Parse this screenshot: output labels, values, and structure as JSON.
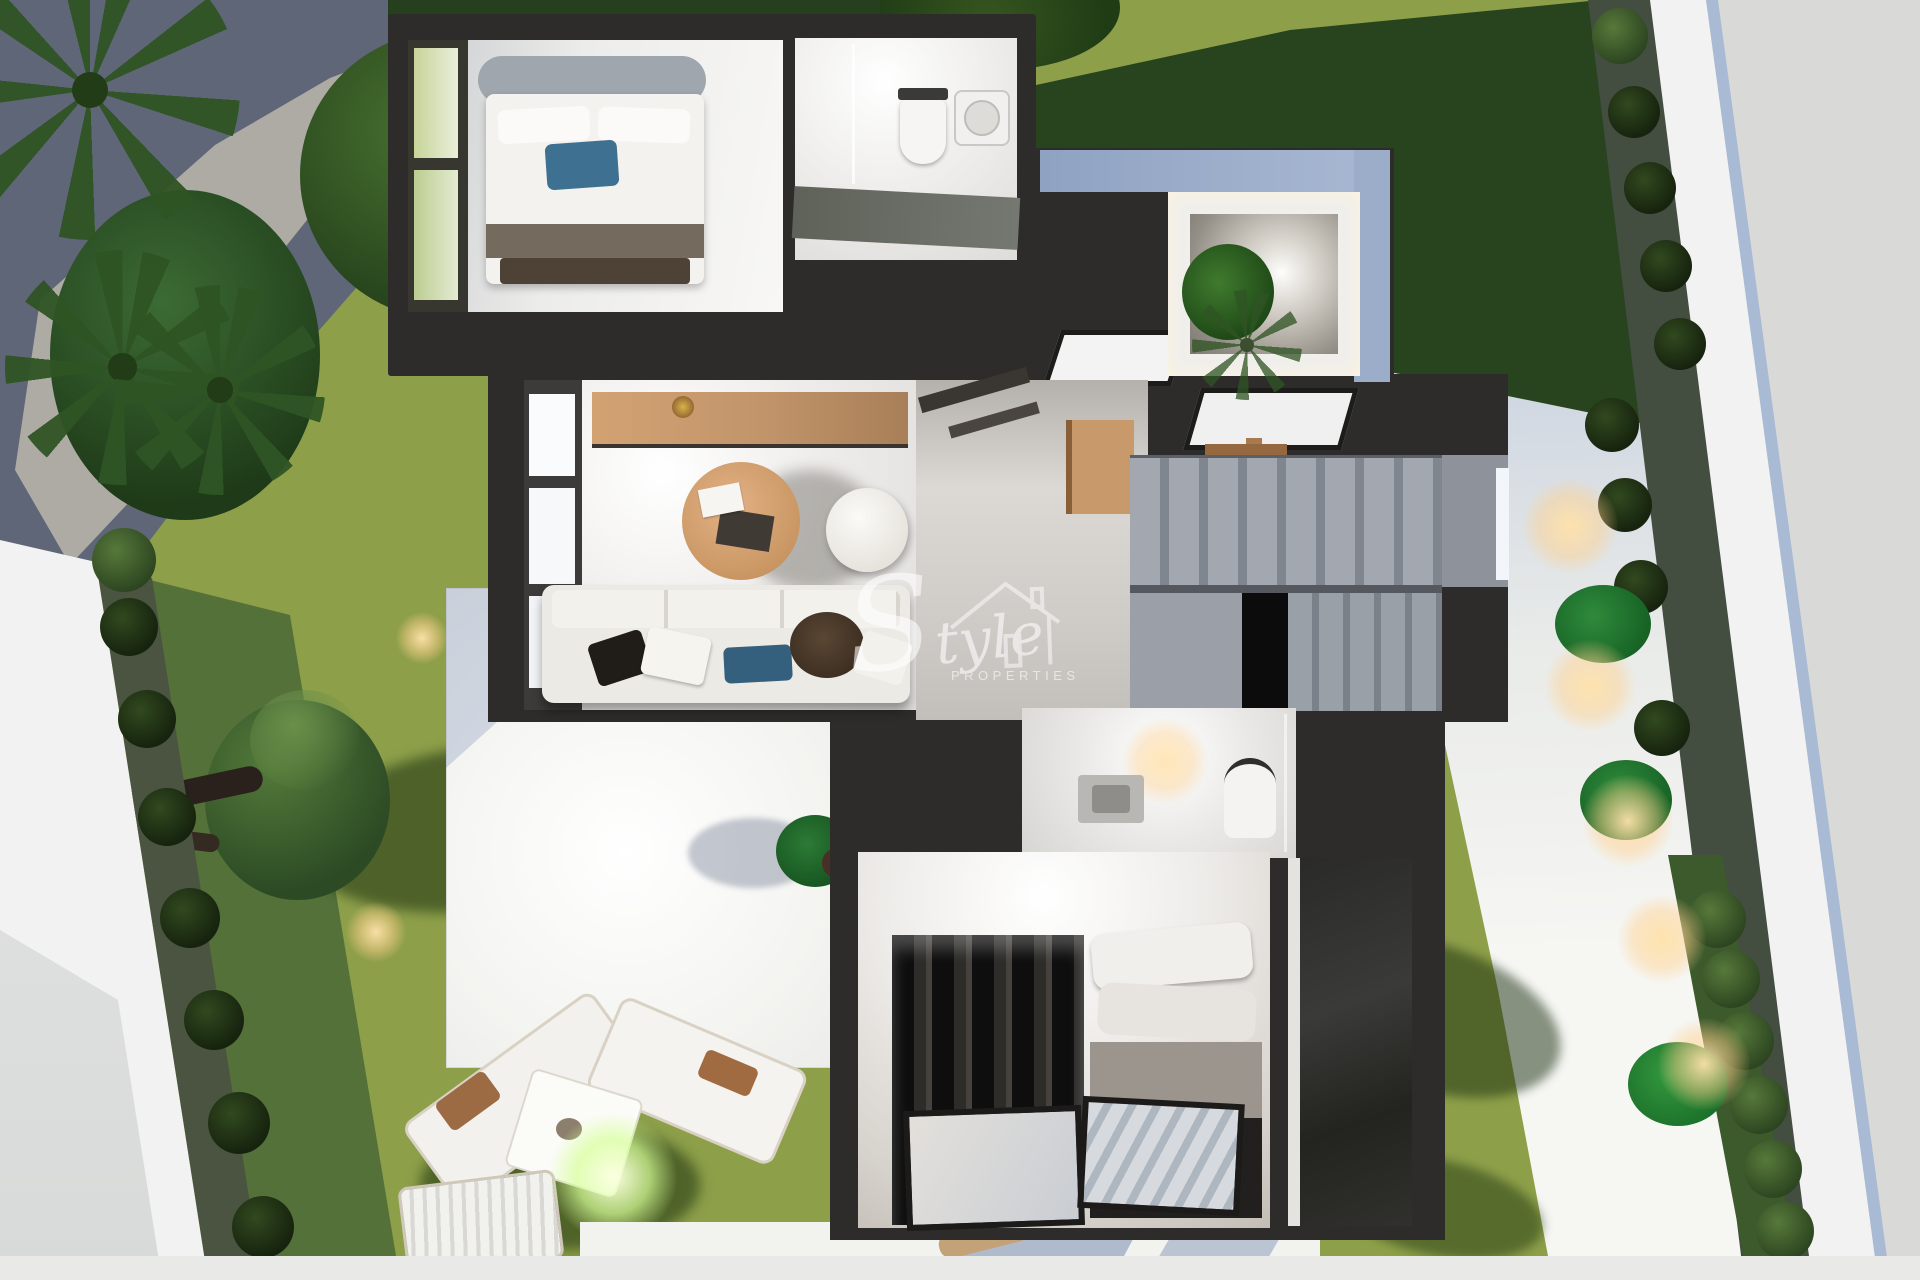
{
  "watermark": {
    "script": "Style",
    "caps": "PROPERTIES",
    "color": "#ffffff"
  },
  "palette": {
    "wall_dark": "#2d2c2a",
    "lawn_sun": "#8d9f49",
    "lawn_shade": "#54713a",
    "lawn_dark": "#27441f",
    "path_shade": "#5f6678",
    "path_sun": "#b5b1a8",
    "pavement_sun": "#f4f4f1",
    "pavement_shade": "#aebcd3",
    "outside_gray": "#d9d9d7",
    "wall_white": "#f1f2f1",
    "floor_marble": "#e9e7e4",
    "stair_gray": "#8d929b",
    "wood_tan": "#d2a273",
    "sofa_white": "#eceae5",
    "pillow_blue": "#35607d",
    "bed_pillow_blue": "#3e7092",
    "wardrobe_black": "#171715",
    "glow_warm": "#ffd9a3",
    "glow_green": "#e4ffb0"
  }
}
